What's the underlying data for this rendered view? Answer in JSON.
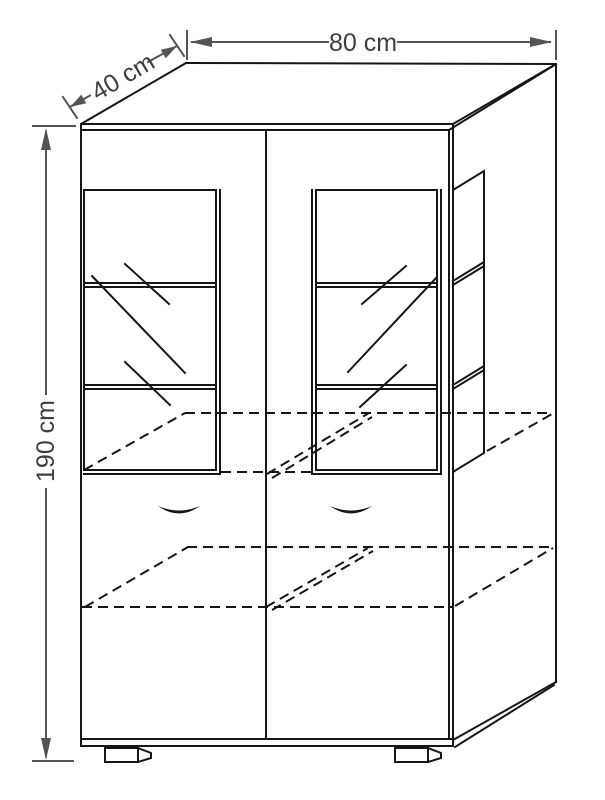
{
  "dims": {
    "width": "80 cm",
    "depth": "40 cm",
    "height": "190 cm"
  },
  "colors": {
    "line": "#161616",
    "dim": "#555555",
    "dimText": "#3e3e3e",
    "bg": "#ffffff"
  }
}
